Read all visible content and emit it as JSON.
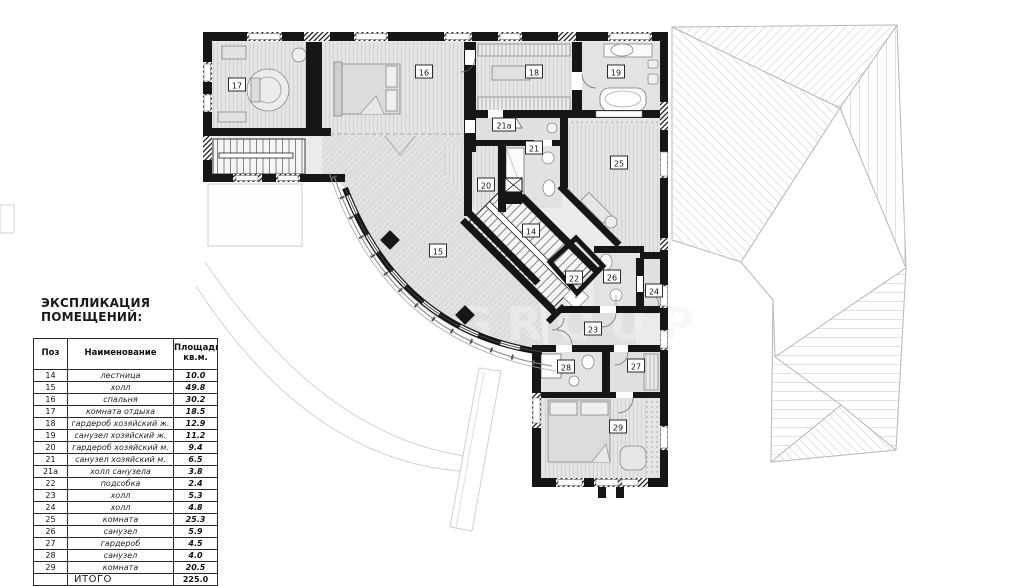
{
  "title": "ЭКСПЛИКАЦИЯ ПОМЕЩЕНИЙ:",
  "table": {
    "headers": {
      "pos": "Поз",
      "name": "Наименование",
      "area_line1": "Площадь",
      "area_line2": "кв.м."
    },
    "rows": [
      {
        "pos": "14",
        "name": "лестница",
        "area": "10.0"
      },
      {
        "pos": "15",
        "name": "холл",
        "area": "49.8"
      },
      {
        "pos": "16",
        "name": "спальня",
        "area": "30.2"
      },
      {
        "pos": "17",
        "name": "комната отдыха",
        "area": "18.5"
      },
      {
        "pos": "18",
        "name": "гардероб хозяйский ж.",
        "area": "12.9"
      },
      {
        "pos": "19",
        "name": "санузел хозяйский ж.",
        "area": "11.2"
      },
      {
        "pos": "20",
        "name": "гардероб хозяйский м.",
        "area": "9.4"
      },
      {
        "pos": "21",
        "name": "санузел хозяйский м.",
        "area": "6.5"
      },
      {
        "pos": "21а",
        "name": "холл санузела",
        "area": "3.8"
      },
      {
        "pos": "22",
        "name": "подсобка",
        "area": "2.4"
      },
      {
        "pos": "23",
        "name": "холл",
        "area": "5.3"
      },
      {
        "pos": "24",
        "name": "холл",
        "area": "4.8"
      },
      {
        "pos": "25",
        "name": "комната",
        "area": "25.3"
      },
      {
        "pos": "26",
        "name": "санузел",
        "area": "5.9"
      },
      {
        "pos": "27",
        "name": "гардероб",
        "area": "4.5"
      },
      {
        "pos": "28",
        "name": "санузел",
        "area": "4.0"
      },
      {
        "pos": "29",
        "name": "комната",
        "area": "20.5"
      }
    ],
    "total_label": "ИТОГО",
    "total_area": "225.0"
  },
  "plan": {
    "watermark": "GROUP",
    "rooms": [
      {
        "label": "14",
        "x": 531,
        "y": 231
      },
      {
        "label": "15",
        "x": 438,
        "y": 251
      },
      {
        "label": "16",
        "x": 424,
        "y": 72
      },
      {
        "label": "17",
        "x": 237,
        "y": 85
      },
      {
        "label": "18",
        "x": 534,
        "y": 72
      },
      {
        "label": "19",
        "x": 616,
        "y": 72
      },
      {
        "label": "20",
        "x": 486,
        "y": 185
      },
      {
        "label": "21",
        "x": 534,
        "y": 148
      },
      {
        "label": "21а",
        "x": 504,
        "y": 125
      },
      {
        "label": "22",
        "x": 574,
        "y": 278
      },
      {
        "label": "23",
        "x": 593,
        "y": 329
      },
      {
        "label": "24",
        "x": 654,
        "y": 291
      },
      {
        "label": "25",
        "x": 619,
        "y": 163
      },
      {
        "label": "26",
        "x": 612,
        "y": 277
      },
      {
        "label": "27",
        "x": 636,
        "y": 366
      },
      {
        "label": "28",
        "x": 566,
        "y": 367
      },
      {
        "label": "29",
        "x": 618,
        "y": 427
      }
    ]
  },
  "colors": {
    "wall": "#161616",
    "floor": "#e4e4e4",
    "roof_line": "#b5b5b5"
  }
}
